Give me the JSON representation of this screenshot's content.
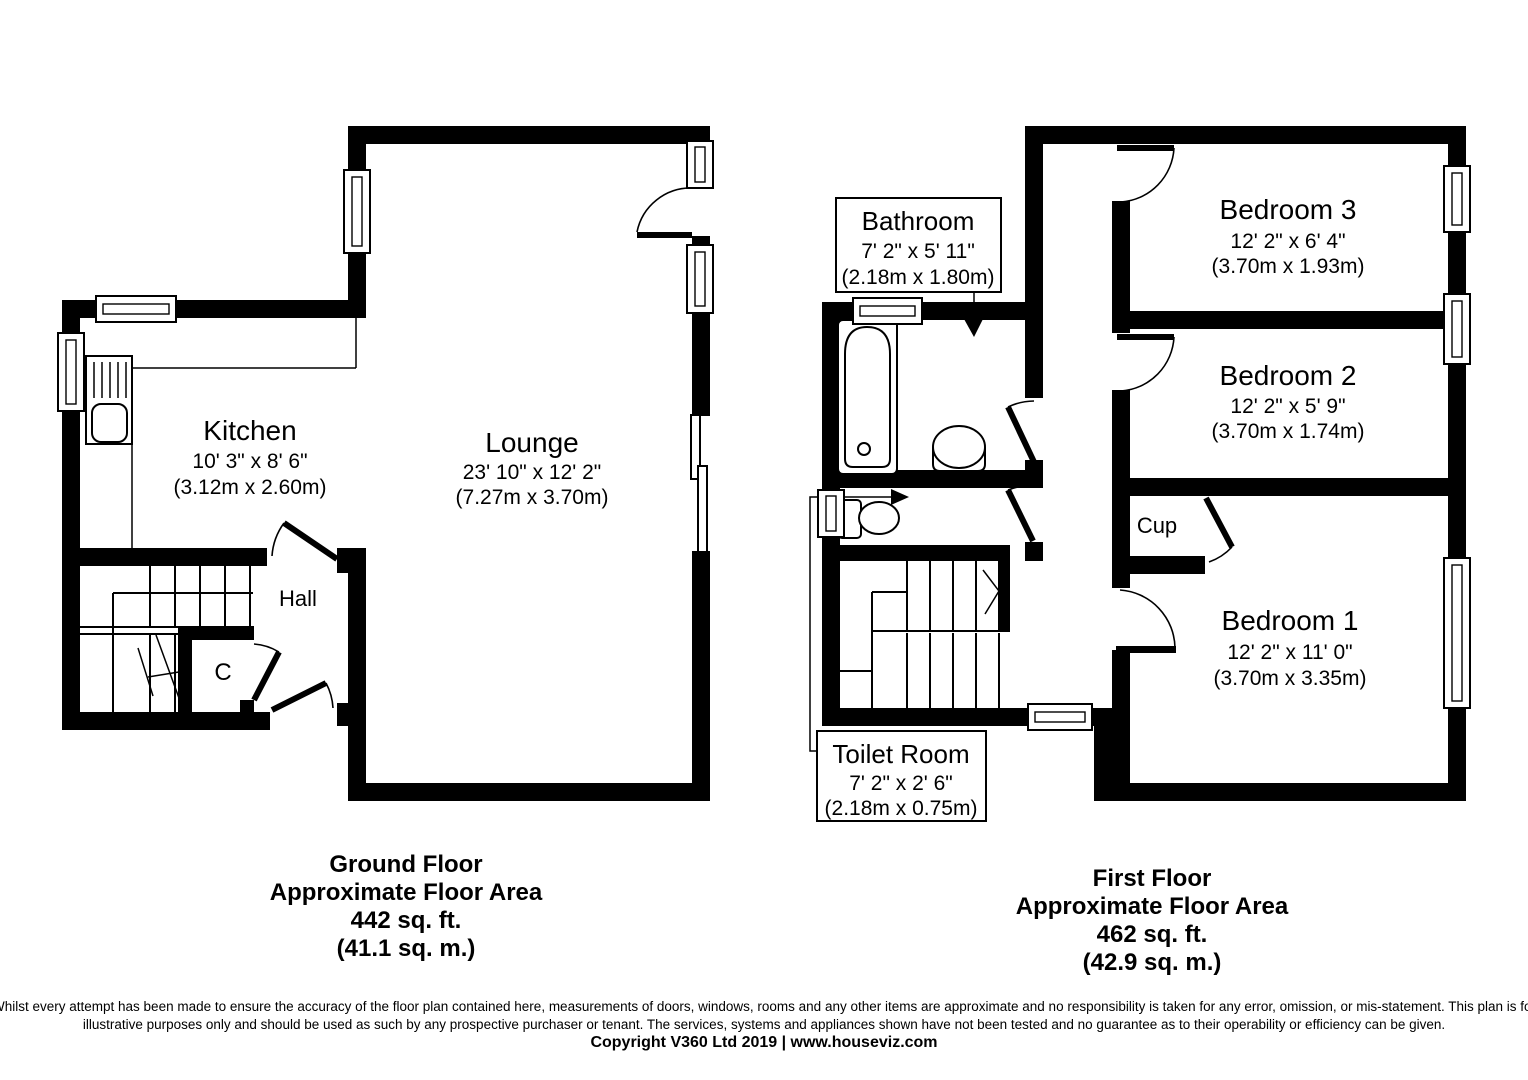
{
  "ground_floor": {
    "rooms": {
      "kitchen": {
        "name": "Kitchen",
        "imperial": "10' 3\" x 8' 6\"",
        "metric": "(3.12m x 2.60m)"
      },
      "lounge": {
        "name": "Lounge",
        "imperial": "23' 10\" x 12' 2\"",
        "metric": "(7.27m x 3.70m)"
      },
      "hall": {
        "name": "Hall"
      },
      "cupboard": {
        "name": "C"
      }
    },
    "summary": {
      "title": "Ground Floor",
      "line2": "Approximate Floor Area",
      "line3": "442 sq. ft.",
      "line4": "(41.1 sq. m.)"
    }
  },
  "first_floor": {
    "rooms": {
      "bathroom": {
        "name": "Bathroom",
        "imperial": "7' 2\" x 5' 11\"",
        "metric": "(2.18m x 1.80m)"
      },
      "toilet_room": {
        "name": "Toilet Room",
        "imperial": "7' 2\" x 2' 6\"",
        "metric": "(2.18m x 0.75m)"
      },
      "bedroom3": {
        "name": "Bedroom 3",
        "imperial": "12' 2\" x 6' 4\"",
        "metric": "(3.70m x 1.93m)"
      },
      "bedroom2": {
        "name": "Bedroom 2",
        "imperial": "12' 2\" x 5' 9\"",
        "metric": "(3.70m x 1.74m)"
      },
      "bedroom1": {
        "name": "Bedroom 1",
        "imperial": "12' 2\" x 11' 0\"",
        "metric": "(3.70m x 3.35m)"
      },
      "cupboard": {
        "name": "Cup"
      }
    },
    "summary": {
      "title": "First Floor",
      "line2": "Approximate Floor Area",
      "line3": "462 sq. ft.",
      "line4": "(42.9 sq. m.)"
    }
  },
  "footer": {
    "disclaimer_line1": "Whilst every attempt has been made to ensure the accuracy of the floor plan contained here, measurements of doors, windows, rooms and any other items are approximate and no responsibility is taken for any error, omission, or mis-statement. This plan is for",
    "disclaimer_line2": "illustrative purposes only and should be used as such by any prospective purchaser or tenant. The services, systems and appliances shown have not been tested and no guarantee as to their operability or efficiency can be given.",
    "copyright": "Copyright V360 Ltd 2019 | www.houseviz.com"
  },
  "colors": {
    "wall": "#000000",
    "background": "#ffffff"
  }
}
